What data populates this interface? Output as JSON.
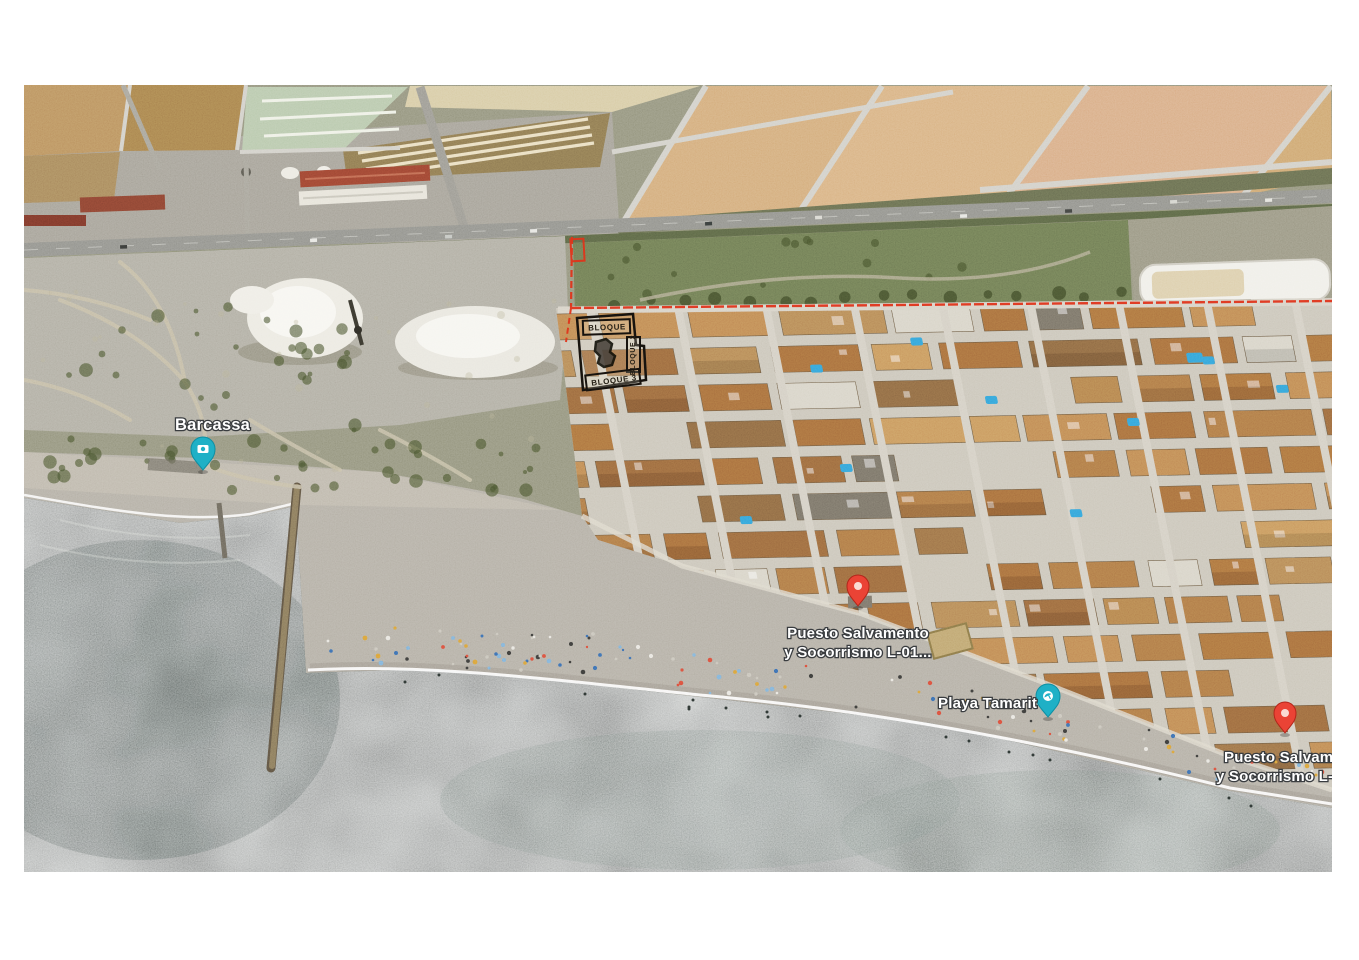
{
  "page": {
    "background": "#ffffff"
  },
  "map": {
    "type": "satellite-map",
    "labels": {
      "barcassa": {
        "text": "Barcassa"
      },
      "puesto_1": {
        "line1": "Puesto Salvamento",
        "line2": "y Socorrismo L-01..."
      },
      "playa_tamarit": {
        "text": "Playa Tamarit"
      },
      "puesto_2": {
        "line1": "Puesto Salvamen",
        "line2": "y Socorrismo L-0"
      }
    },
    "markers": {
      "barcassa_photo": {
        "kind": "photo-poi",
        "color": "#1fb0c6"
      },
      "puesto_1_pin": {
        "kind": "place-pin",
        "color": "#ea4335"
      },
      "playa_pin": {
        "kind": "beach-poi",
        "color": "#1fb0c6"
      },
      "puesto_2_pin": {
        "kind": "place-pin",
        "color": "#ea4335"
      }
    },
    "site_plan": {
      "bloque_1": "BLOQUE",
      "bloque_2": "BLOQUE 2",
      "bloque_3": "BLOQUE 3"
    },
    "colors": {
      "boundary_red": "#e0351b",
      "pin_red": "#ea4335",
      "poi_teal": "#1fb0c6",
      "sea": "#55615d",
      "sand": "#b5b0a6",
      "scrub": "#95957e",
      "pond_tan": "#d4ad7c",
      "pond_green": "#b9c9ad",
      "salt_white": "#f2f1ec",
      "roof_orange": "#b07a48"
    }
  }
}
